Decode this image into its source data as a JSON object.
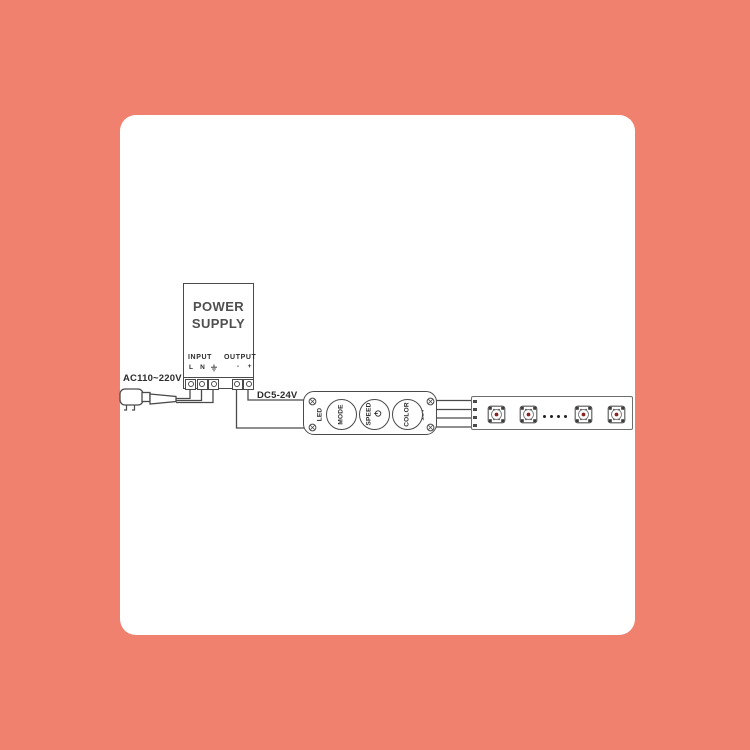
{
  "colors": {
    "background": "#F0816F",
    "card": "#FFFFFF",
    "line": "#4A4A4A",
    "text": "#2B2B2B",
    "led_red": "#8A2323"
  },
  "diagram": {
    "power_supply": {
      "title": "POWER\nSUPPLY",
      "input_label": "INPUT",
      "output_label": "OUTPUT",
      "pins": {
        "l": "L",
        "n": "N",
        "ground_icon": "earth-ground",
        "minus": "-",
        "plus": "+"
      }
    },
    "ac_label": "AC110~220V",
    "dc_label": "DC5-24V",
    "controller": {
      "left_label": "LED",
      "right_label": "12V",
      "buttons": [
        "MODE",
        "SPEED",
        "COLOR"
      ],
      "speed_icon": "power-icon"
    },
    "led_strip": {
      "module_count": 4,
      "continuation_dots": 4
    }
  }
}
